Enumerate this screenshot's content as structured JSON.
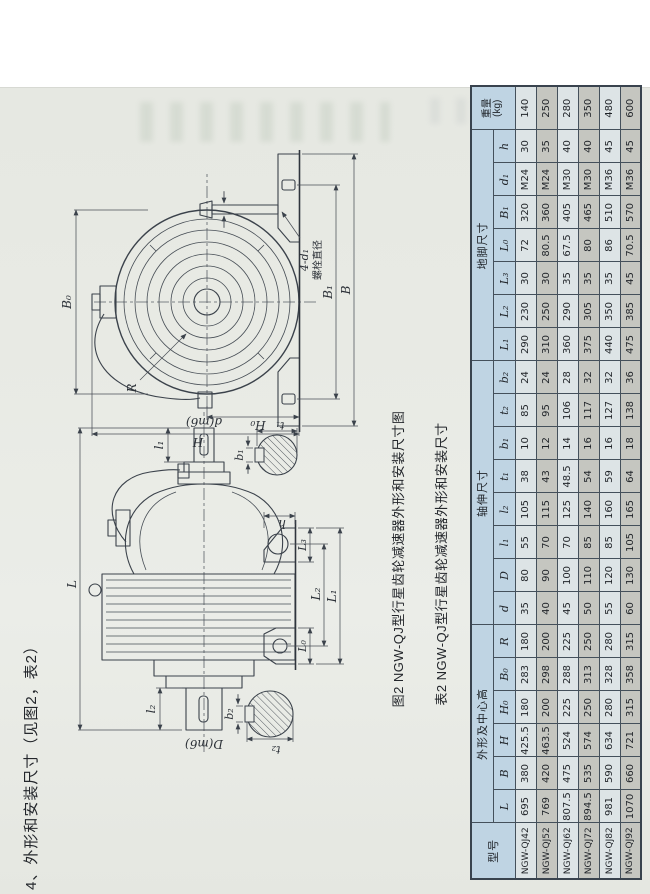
{
  "page": {
    "section_heading": "4、外形和安装尺寸（见图2，表2）"
  },
  "figure": {
    "caption": "图2  NGW-QJ型行星齿轮减速器外形和安装尺寸图",
    "side_view": {
      "L": "L",
      "l1": "l₁",
      "l2": "l₂",
      "d_shaft": "d(m6)",
      "D_shaft": "D(m6)",
      "h": "h",
      "L0": "L₀",
      "L1": "L₁",
      "L2": "L₂",
      "L3": "L₃",
      "b1": "b₁",
      "t1": "t₁",
      "b2": "b₂",
      "t2": "t₂"
    },
    "end_view": {
      "B0": "B₀",
      "R": "R",
      "H": "H",
      "H0": "H₀",
      "B1": "B₁",
      "B": "B",
      "bolt_qty": "4-d₁",
      "bolt_note": "螺栓直径"
    }
  },
  "table": {
    "caption": "表2  NGW-QJ型行星齿轮减速器外形和安装尺寸",
    "group_headers": {
      "model": "型号",
      "outline": "外形及中心高",
      "shaft": "轴伸尺寸",
      "foot": "地脚尺寸",
      "weight": "重量\n(kg)"
    },
    "sub_headers": [
      "L",
      "B",
      "H",
      "H₀",
      "B₀",
      "R",
      "d",
      "D",
      "l₁",
      "l₂",
      "t₁",
      "b₁",
      "t₂",
      "b₂",
      "L₁",
      "L₂",
      "L₃",
      "L₀",
      "B₁",
      "d₁",
      "h"
    ],
    "rows": [
      [
        "NGW-QJ42",
        "695",
        "380",
        "425.5",
        "180",
        "283",
        "180",
        "35",
        "80",
        "55",
        "105",
        "38",
        "10",
        "85",
        "24",
        "290",
        "230",
        "30",
        "72",
        "320",
        "M24",
        "30",
        "140"
      ],
      [
        "NGW-QJ52",
        "769",
        "420",
        "463.5",
        "200",
        "298",
        "200",
        "40",
        "90",
        "70",
        "115",
        "43",
        "12",
        "95",
        "24",
        "310",
        "250",
        "30",
        "80.5",
        "360",
        "M24",
        "35",
        "250"
      ],
      [
        "NGW-QJ62",
        "807.5",
        "475",
        "524",
        "225",
        "288",
        "225",
        "45",
        "100",
        "70",
        "125",
        "48.5",
        "14",
        "106",
        "28",
        "360",
        "290",
        "35",
        "67.5",
        "405",
        "M30",
        "40",
        "280"
      ],
      [
        "NGW-QJ72",
        "894.5",
        "535",
        "574",
        "250",
        "313",
        "250",
        "50",
        "110",
        "85",
        "140",
        "54",
        "16",
        "117",
        "32",
        "375",
        "305",
        "35",
        "80",
        "465",
        "M30",
        "40",
        "350"
      ],
      [
        "NGW-QJ82",
        "981",
        "590",
        "634",
        "280",
        "328",
        "280",
        "55",
        "120",
        "85",
        "160",
        "59",
        "16",
        "127",
        "32",
        "440",
        "350",
        "35",
        "86",
        "510",
        "M36",
        "45",
        "480"
      ],
      [
        "NGW-QJ92",
        "1070",
        "660",
        "721",
        "315",
        "358",
        "315",
        "60",
        "130",
        "105",
        "165",
        "64",
        "18",
        "138",
        "36",
        "475",
        "385",
        "45",
        "70.5",
        "570",
        "M36",
        "45",
        "600"
      ]
    ]
  }
}
